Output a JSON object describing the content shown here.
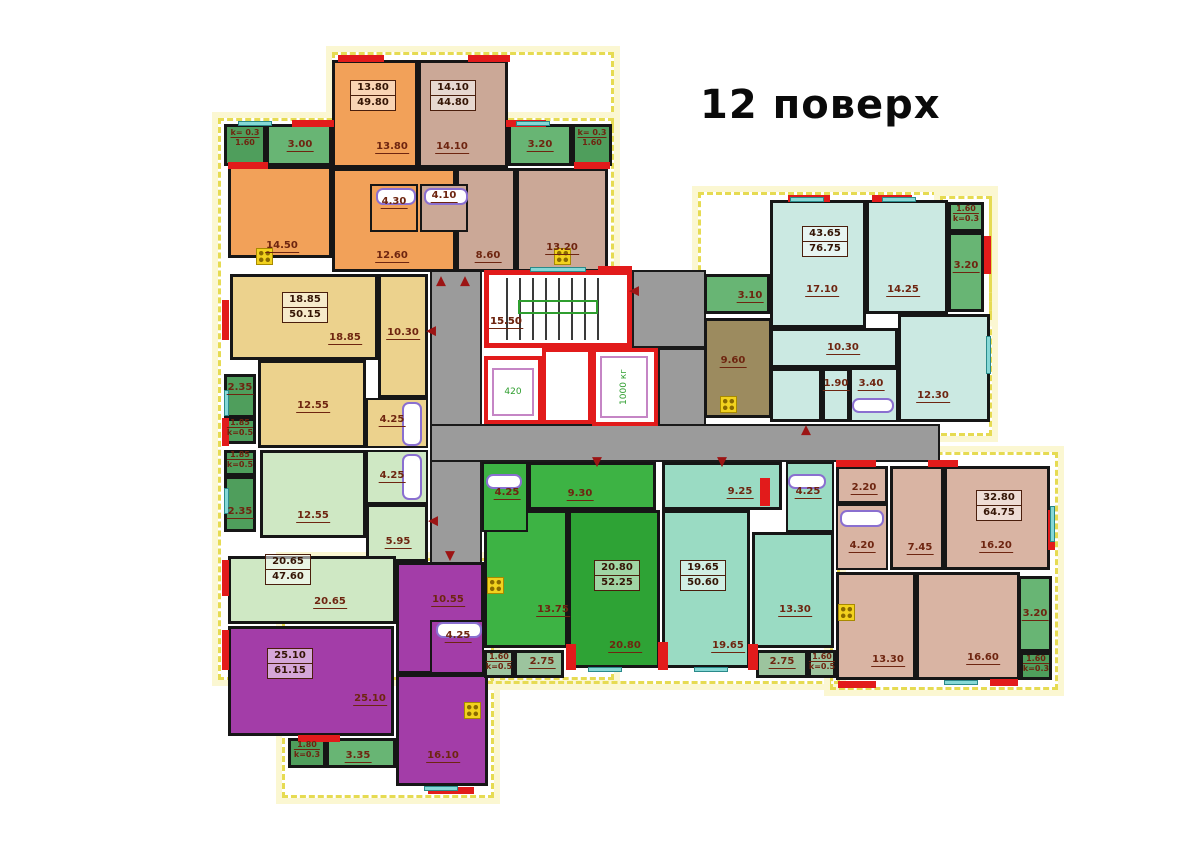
{
  "title": "12 поверх",
  "palette": {
    "orange": "#f2a159",
    "tan": "#cba897",
    "khaki": "#ecd28d",
    "lightgreen": "#cfe8c4",
    "purple": "#a33da8",
    "green_dark": "#2ea335",
    "green_light": "#3db344",
    "teal": "#9adbc3",
    "palecyan": "#cbe9e2",
    "rose": "#d9b4a3",
    "brown": "#9c8b5f",
    "balc_green": "#68b574",
    "balc_dark": "#4f9e5c",
    "balc_gray": "#9cc49e",
    "corridor": "#9b9b9b",
    "wall_red": "#e21b1b",
    "outline_yellow": "#e6db52",
    "label": "#6e2510"
  },
  "outline_rects": [
    [
      332,
      52,
      282,
      78
    ],
    [
      218,
      118,
      396,
      562
    ],
    [
      282,
      558,
      212,
      240
    ],
    [
      478,
      452,
      362,
      232
    ],
    [
      698,
      192,
      294,
      244
    ],
    [
      830,
      452,
      228,
      238
    ],
    [
      940,
      196,
      52,
      124
    ]
  ],
  "corridor_rects": [
    [
      430,
      268,
      52,
      296
    ],
    [
      632,
      270,
      74,
      78
    ],
    [
      658,
      348,
      48,
      78
    ],
    [
      430,
      424,
      510,
      38
    ]
  ],
  "rooms": {
    "fields": [
      "name",
      "x",
      "y",
      "w",
      "h",
      "color",
      "hatch"
    ],
    "items": [
      [
        "room-13-80",
        332,
        60,
        86,
        108,
        "orange",
        0
      ],
      [
        "room-14-10",
        418,
        60,
        90,
        108,
        "tan",
        0
      ],
      [
        "balcony-1-60-topleft",
        224,
        124,
        42,
        42,
        "balc_dark",
        0
      ],
      [
        "balcony-3-00",
        266,
        124,
        66,
        42,
        "balc_green",
        0
      ],
      [
        "balcony-3-20-top",
        508,
        124,
        64,
        42,
        "balc_green",
        0
      ],
      [
        "balcony-1-60-topmid",
        572,
        124,
        40,
        42,
        "balc_dark",
        0
      ],
      [
        "room-14-50",
        228,
        166,
        104,
        92,
        "orange",
        0
      ],
      [
        "room-12-60",
        332,
        168,
        124,
        104,
        "orange",
        0
      ],
      [
        "room-8-60",
        456,
        168,
        60,
        104,
        "tan",
        0
      ],
      [
        "room-13-20",
        516,
        168,
        92,
        104,
        "tan",
        0
      ],
      [
        "bath-4-30",
        370,
        184,
        48,
        48,
        "orange",
        0
      ],
      [
        "bath-4-10",
        420,
        184,
        48,
        48,
        "tan",
        0
      ],
      [
        "room-18-85",
        230,
        274,
        148,
        86,
        "khaki",
        0
      ],
      [
        "room-10-30-left",
        378,
        274,
        50,
        124,
        "khaki",
        0
      ],
      [
        "room-12-55-khaki",
        258,
        360,
        108,
        88,
        "khaki",
        0
      ],
      [
        "bath-4-25-khaki",
        366,
        398,
        62,
        50,
        "khaki",
        0
      ],
      [
        "balcony-2-35-a",
        224,
        374,
        32,
        44,
        "balc_dark",
        0
      ],
      [
        "balcony-1-85-a",
        224,
        418,
        32,
        26,
        "balc_dark",
        0
      ],
      [
        "balcony-1-85-b",
        224,
        450,
        32,
        26,
        "balc_dark",
        0
      ],
      [
        "balcony-2-35-b",
        224,
        476,
        32,
        56,
        "balc_dark",
        0
      ],
      [
        "room-12-55-green",
        260,
        450,
        106,
        88,
        "lightgreen",
        0
      ],
      [
        "bath-4-25-lightgreen",
        366,
        450,
        62,
        54,
        "lightgreen",
        0
      ],
      [
        "room-5-95",
        366,
        504,
        62,
        58,
        "lightgreen",
        0
      ],
      [
        "room-20-65",
        228,
        556,
        168,
        68,
        "lightgreen",
        0
      ],
      [
        "room-25-10",
        228,
        626,
        166,
        110,
        "purple",
        0
      ],
      [
        "room-10-55",
        396,
        562,
        88,
        112,
        "purple",
        0
      ],
      [
        "bath-4-25-purple",
        430,
        620,
        54,
        54,
        "purple",
        0
      ],
      [
        "room-16-10",
        396,
        674,
        92,
        112,
        "purple",
        0
      ],
      [
        "balcony-1-80",
        288,
        738,
        38,
        30,
        "balc_dark",
        0
      ],
      [
        "balcony-3-35",
        326,
        738,
        70,
        30,
        "balc_green",
        0
      ],
      [
        "bath-4-25-greenapt",
        482,
        462,
        46,
        70,
        "green_light",
        0
      ],
      [
        "room-9-30",
        528,
        462,
        128,
        48,
        "green_light",
        0
      ],
      [
        "room-13-75",
        484,
        510,
        84,
        138,
        "green_light",
        0
      ],
      [
        "room-20-80",
        568,
        510,
        92,
        158,
        "green_dark",
        0
      ],
      [
        "balcony-1-60-bc-left",
        484,
        650,
        30,
        28,
        "balc_gray",
        0
      ],
      [
        "balcony-2-75-left",
        514,
        650,
        50,
        28,
        "balc_gray",
        0
      ],
      [
        "room-9-25",
        662,
        462,
        120,
        48,
        "teal",
        0
      ],
      [
        "room-19-65",
        662,
        510,
        88,
        158,
        "teal",
        0
      ],
      [
        "room-13-30-teal",
        752,
        532,
        82,
        116,
        "teal",
        0
      ],
      [
        "bath-4-25-teal",
        786,
        462,
        48,
        70,
        "teal",
        0
      ],
      [
        "balcony-2-75-right",
        756,
        650,
        52,
        28,
        "balc_gray",
        0
      ],
      [
        "balcony-1-60-bc-right",
        808,
        650,
        28,
        28,
        "balc_gray",
        0
      ],
      [
        "balcony-3-10",
        704,
        274,
        66,
        40,
        "balc_green",
        0
      ],
      [
        "room-9-60",
        704,
        318,
        68,
        100,
        "brown",
        0
      ],
      [
        "room-17-10",
        770,
        200,
        96,
        128,
        "palecyan",
        0
      ],
      [
        "room-14-25",
        866,
        200,
        82,
        114,
        "palecyan",
        0
      ],
      [
        "room-10-30-right",
        770,
        328,
        128,
        40,
        "palecyan",
        0
      ],
      [
        "hall-filler",
        770,
        368,
        52,
        54,
        "palecyan",
        0
      ],
      [
        "room-1-90",
        822,
        368,
        28,
        54,
        "palecyan",
        0
      ],
      [
        "bath-3-40",
        850,
        368,
        48,
        54,
        "palecyan",
        0
      ],
      [
        "room-12-30",
        898,
        314,
        92,
        108,
        "palecyan",
        0
      ],
      [
        "balcony-1-60-topright",
        948,
        202,
        36,
        30,
        "balc_green",
        0
      ],
      [
        "balcony-3-20-topright",
        948,
        232,
        36,
        80,
        "balc_green",
        1
      ],
      [
        "room-2-20",
        836,
        466,
        52,
        38,
        "rose",
        0
      ],
      [
        "bath-4-20",
        836,
        504,
        52,
        66,
        "rose",
        0
      ],
      [
        "room-7-45",
        890,
        466,
        54,
        104,
        "rose",
        0
      ],
      [
        "room-16-20",
        944,
        466,
        106,
        104,
        "rose",
        0
      ],
      [
        "room-13-30-rose",
        836,
        572,
        80,
        108,
        "rose",
        0
      ],
      [
        "room-16-60",
        916,
        572,
        104,
        108,
        "rose",
        0
      ],
      [
        "balcony-3-20-botright",
        1018,
        576,
        34,
        76,
        "balc_green",
        1
      ],
      [
        "balcony-1-60-botright",
        1020,
        652,
        32,
        28,
        "balc_dark",
        0
      ]
    ]
  },
  "room_labels": [
    [
      392,
      141,
      "13.80"
    ],
    [
      452,
      141,
      "14.10"
    ],
    [
      300,
      139,
      "3.00"
    ],
    [
      540,
      139,
      "3.20"
    ],
    [
      282,
      240,
      "14.50"
    ],
    [
      392,
      250,
      "12.60"
    ],
    [
      488,
      250,
      "8.60"
    ],
    [
      562,
      242,
      "13.20"
    ],
    [
      394,
      196,
      "4.30"
    ],
    [
      444,
      190,
      "4.10"
    ],
    [
      345,
      332,
      "18.85"
    ],
    [
      403,
      327,
      "10.30"
    ],
    [
      313,
      400,
      "12.55"
    ],
    [
      392,
      414,
      "4.25"
    ],
    [
      240,
      382,
      "2.35"
    ],
    [
      240,
      506,
      "2.35"
    ],
    [
      313,
      510,
      "12.55"
    ],
    [
      392,
      470,
      "4.25"
    ],
    [
      398,
      536,
      "5.95"
    ],
    [
      330,
      596,
      "20.65"
    ],
    [
      370,
      693,
      "25.10"
    ],
    [
      448,
      594,
      "10.55"
    ],
    [
      458,
      630,
      "4.25"
    ],
    [
      443,
      750,
      "16.10"
    ],
    [
      358,
      750,
      "3.35"
    ],
    [
      507,
      487,
      "4.25"
    ],
    [
      580,
      488,
      "9.30"
    ],
    [
      553,
      604,
      "13.75"
    ],
    [
      625,
      640,
      "20.80"
    ],
    [
      542,
      656,
      "2.75"
    ],
    [
      740,
      486,
      "9.25"
    ],
    [
      728,
      640,
      "19.65"
    ],
    [
      795,
      604,
      "13.30"
    ],
    [
      808,
      486,
      "4.25"
    ],
    [
      782,
      656,
      "2.75"
    ],
    [
      733,
      355,
      "9.60"
    ],
    [
      750,
      290,
      "3.10"
    ],
    [
      822,
      284,
      "17.10"
    ],
    [
      903,
      284,
      "14.25"
    ],
    [
      843,
      342,
      "10.30"
    ],
    [
      836,
      378,
      "1.90"
    ],
    [
      871,
      378,
      "3.40"
    ],
    [
      933,
      390,
      "12.30"
    ],
    [
      966,
      260,
      "3.20"
    ],
    [
      864,
      482,
      "2.20"
    ],
    [
      862,
      540,
      "4.20"
    ],
    [
      920,
      542,
      "7.45"
    ],
    [
      996,
      540,
      "16.20"
    ],
    [
      888,
      654,
      "13.30"
    ],
    [
      983,
      652,
      "16.60"
    ],
    [
      1035,
      608,
      "3.20"
    ],
    [
      506,
      316,
      "15.50"
    ]
  ],
  "coef_labels": [
    [
      245,
      128,
      "k= 0.3",
      "1.60"
    ],
    [
      592,
      128,
      "k= 0.3",
      "1.60"
    ],
    [
      240,
      418,
      "1.85",
      "k=0.5"
    ],
    [
      240,
      450,
      "1.85",
      "k=0.5"
    ],
    [
      307,
      740,
      "1.80",
      "k=0.3"
    ],
    [
      499,
      652,
      "1.60",
      "k=0.5"
    ],
    [
      822,
      652,
      "1.60",
      "k=0.5"
    ],
    [
      966,
      204,
      "1.60",
      "k=0.3"
    ],
    [
      1036,
      654,
      "1.60",
      "k=0.3"
    ]
  ],
  "apartment_boxes": [
    [
      373,
      80,
      "13.80",
      "49.80"
    ],
    [
      453,
      80,
      "14.10",
      "44.80"
    ],
    [
      305,
      292,
      "18.85",
      "50.15"
    ],
    [
      288,
      554,
      "20.65",
      "47.60"
    ],
    [
      290,
      648,
      "25.10",
      "61.15"
    ],
    [
      617,
      560,
      "20.80",
      "52.25"
    ],
    [
      703,
      560,
      "19.65",
      "50.60"
    ],
    [
      825,
      226,
      "43.65",
      "76.75"
    ],
    [
      999,
      490,
      "32.80",
      "64.75"
    ]
  ],
  "core": {
    "stair_room": [
      484,
      270,
      148,
      78
    ],
    "stair_label": "15.50",
    "elevator_small": {
      "shaft": [
        484,
        356,
        58,
        68
      ],
      "car": [
        492,
        368,
        42,
        48
      ],
      "label": "420",
      "label_pos": [
        513,
        392
      ]
    },
    "machine_room": [
      542,
      348,
      50,
      76
    ],
    "elevator_big": {
      "shaft": [
        592,
        348,
        66,
        78
      ],
      "car": [
        600,
        356,
        48,
        62
      ],
      "label": "1000 кг",
      "label_pos": [
        624,
        387
      ]
    }
  },
  "red_segments": [
    [
      338,
      55,
      46,
      7
    ],
    [
      468,
      55,
      42,
      7
    ],
    [
      292,
      120,
      42,
      7
    ],
    [
      506,
      120,
      40,
      7
    ],
    [
      228,
      162,
      40,
      7
    ],
    [
      574,
      162,
      36,
      7
    ],
    [
      222,
      300,
      7,
      40
    ],
    [
      222,
      560,
      7,
      36
    ],
    [
      222,
      630,
      7,
      40
    ],
    [
      298,
      735,
      42,
      7
    ],
    [
      428,
      787,
      46,
      7
    ],
    [
      598,
      266,
      34,
      7
    ],
    [
      788,
      195,
      42,
      7
    ],
    [
      872,
      195,
      40,
      7
    ],
    [
      984,
      236,
      7,
      38
    ],
    [
      836,
      460,
      40,
      7
    ],
    [
      928,
      460,
      30,
      7
    ],
    [
      1048,
      510,
      7,
      40
    ],
    [
      838,
      681,
      38,
      7
    ],
    [
      990,
      679,
      28,
      7
    ],
    [
      566,
      644,
      10,
      26
    ],
    [
      658,
      642,
      10,
      28
    ],
    [
      748,
      644,
      10,
      26
    ],
    [
      760,
      478,
      10,
      28
    ],
    [
      222,
      418,
      7,
      28
    ]
  ],
  "windows": [
    [
      238,
      121,
      34,
      5
    ],
    [
      516,
      121,
      34,
      5
    ],
    [
      224,
      390,
      5,
      26
    ],
    [
      224,
      488,
      5,
      26
    ],
    [
      790,
      197,
      34,
      5
    ],
    [
      882,
      197,
      34,
      5
    ],
    [
      986,
      336,
      5,
      38
    ],
    [
      1050,
      506,
      5,
      36
    ],
    [
      944,
      680,
      34,
      5
    ],
    [
      588,
      667,
      34,
      5
    ],
    [
      694,
      667,
      34,
      5
    ],
    [
      424,
      786,
      34,
      5
    ],
    [
      530,
      267,
      56,
      5
    ]
  ],
  "arrows": [
    [
      441,
      281,
      "up"
    ],
    [
      465,
      281,
      "up"
    ],
    [
      806,
      430,
      "up"
    ],
    [
      450,
      556,
      "down"
    ],
    [
      597,
      462,
      "down"
    ],
    [
      722,
      462,
      "down"
    ],
    [
      431,
      331,
      "left"
    ],
    [
      433,
      521,
      "left"
    ],
    [
      634,
      291,
      "left"
    ]
  ],
  "fixtures": {
    "tubs": [
      [
        376,
        188,
        40,
        17
      ],
      [
        424,
        188,
        44,
        17
      ],
      [
        402,
        402,
        20,
        44
      ],
      [
        402,
        454,
        20,
        46
      ],
      [
        436,
        622,
        46,
        16
      ],
      [
        840,
        510,
        44,
        17
      ],
      [
        852,
        398,
        42,
        15
      ],
      [
        486,
        474,
        36,
        15
      ],
      [
        788,
        474,
        38,
        15
      ]
    ],
    "stoves": [
      [
        256,
        248,
        17,
        17
      ],
      [
        554,
        248,
        17,
        17
      ],
      [
        464,
        702,
        17,
        17
      ],
      [
        720,
        396,
        17,
        17
      ],
      [
        487,
        577,
        17,
        17
      ],
      [
        838,
        604,
        17,
        17
      ]
    ]
  }
}
